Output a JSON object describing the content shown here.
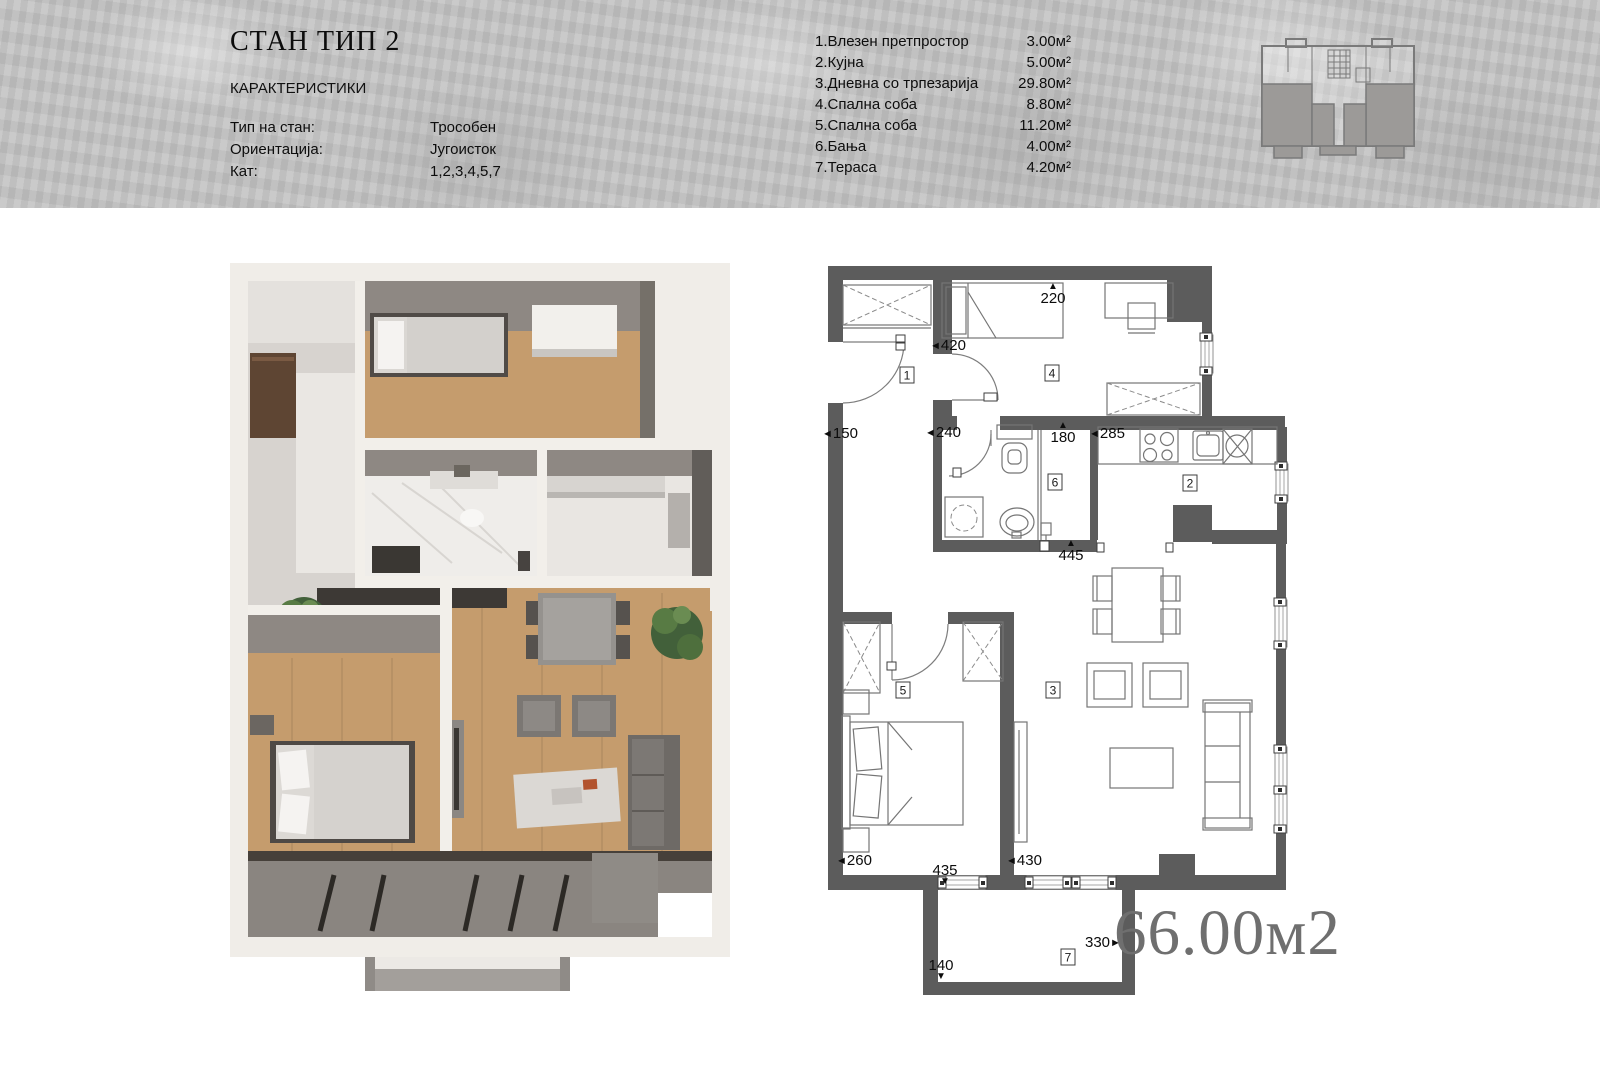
{
  "header": {
    "title": "СТАН ТИП 2",
    "section_label": "КАРАКТЕРИСТИКИ",
    "specs": [
      {
        "label": "Тип на стан:",
        "value": "Трособен"
      },
      {
        "label": "Ориентација:",
        "value": "Југоисток"
      },
      {
        "label": "Кат:",
        "value": "1,2,3,4,5,7"
      }
    ],
    "room_list": [
      {
        "name": "1.Влезен претпростор",
        "area": "3.00м²"
      },
      {
        "name": "2.Кујна",
        "area": "5.00м²"
      },
      {
        "name": "3.Дневна со трпезарија",
        "area": "29.80м²"
      },
      {
        "name": "4.Спална соба",
        "area": "8.80м²"
      },
      {
        "name": "5.Спална соба",
        "area": "11.20м²"
      },
      {
        "name": "6.Бања",
        "area": "4.00м²"
      },
      {
        "name": "7.Тераса",
        "area": "4.20м²"
      }
    ]
  },
  "plan2d": {
    "total_area": "66.00м2",
    "room_markers": [
      {
        "num": "1",
        "x": 907,
        "y": 375
      },
      {
        "num": "4",
        "x": 1052,
        "y": 373
      },
      {
        "num": "6",
        "x": 1055,
        "y": 482
      },
      {
        "num": "2",
        "x": 1190,
        "y": 483
      },
      {
        "num": "5",
        "x": 903,
        "y": 690
      },
      {
        "num": "3",
        "x": 1053,
        "y": 690
      },
      {
        "num": "7",
        "x": 1068,
        "y": 957
      }
    ],
    "dimensions": [
      {
        "text": "220",
        "marker": "above",
        "x": 1053,
        "y": 282
      },
      {
        "text": "420",
        "marker": "before",
        "x": 930,
        "y": 339
      },
      {
        "text": "150",
        "marker": "before",
        "x": 822,
        "y": 427
      },
      {
        "text": "240",
        "marker": "before",
        "x": 925,
        "y": 426
      },
      {
        "text": "180",
        "marker": "above",
        "x": 1063,
        "y": 421
      },
      {
        "text": "285",
        "marker": "before",
        "x": 1089,
        "y": 427
      },
      {
        "text": "445",
        "marker": "above",
        "x": 1071,
        "y": 539
      },
      {
        "text": "260",
        "marker": "before",
        "x": 836,
        "y": 854
      },
      {
        "text": "435",
        "marker": "below",
        "x": 945,
        "y": 864
      },
      {
        "text": "430",
        "marker": "before",
        "x": 1006,
        "y": 854
      },
      {
        "text": "330",
        "marker": "after",
        "x": 1085,
        "y": 936
      },
      {
        "text": "140",
        "marker": "below",
        "x": 941,
        "y": 959
      }
    ]
  },
  "colors": {
    "wall_2d": "#5c5c5c",
    "area_text": "#6f6f6f",
    "header_bg": "#c5c5c5",
    "wood_floor": "#c59c6d",
    "render_wall_gray": "#8e8883",
    "render_outer": "#f0ede8"
  }
}
